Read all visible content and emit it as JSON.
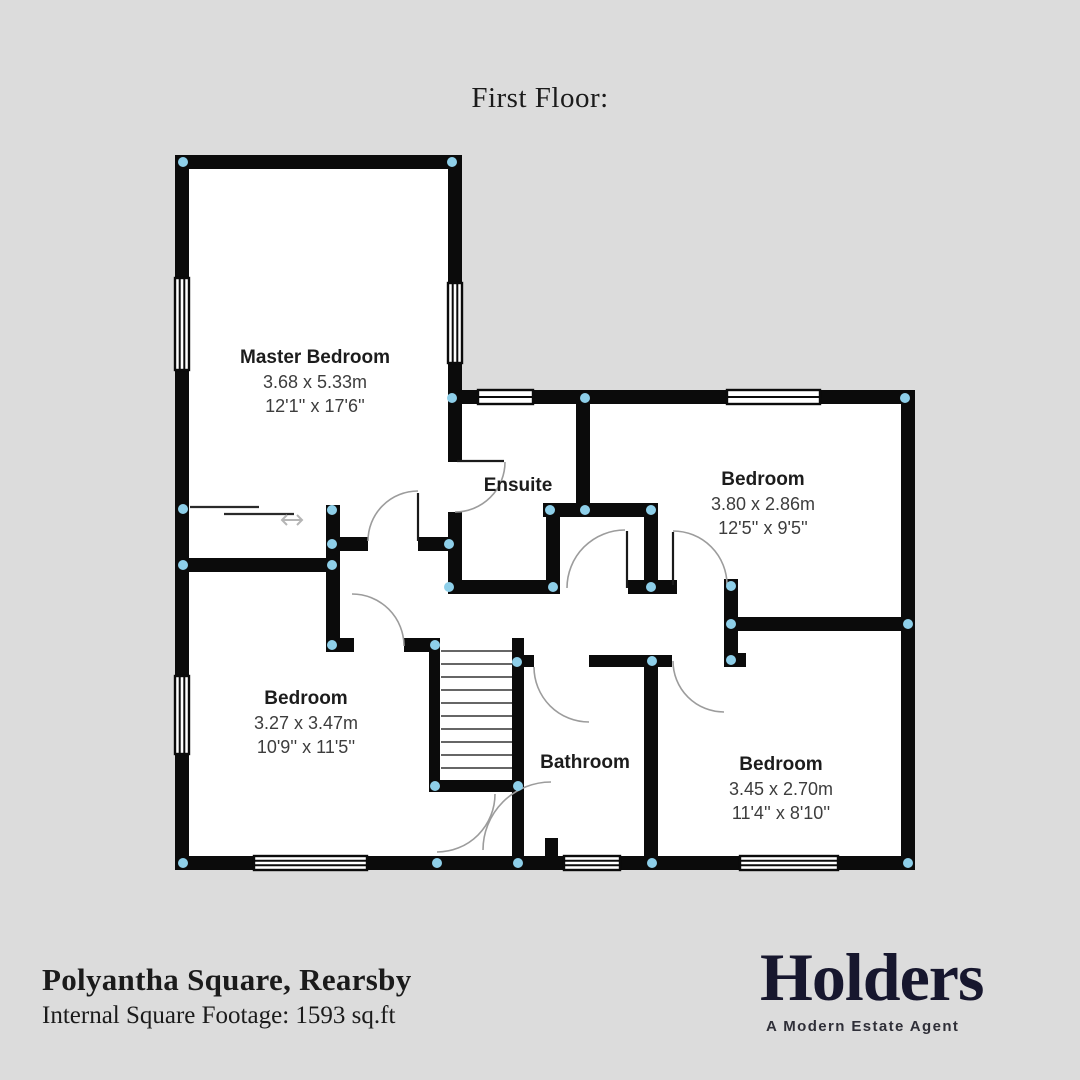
{
  "page": {
    "title": "First Floor:"
  },
  "rooms": [
    {
      "name": "Master Bedroom",
      "dim_m": "3.68 x 5.33m",
      "dim_ft": "12'1'' x 17'6''"
    },
    {
      "name": "Ensuite",
      "dim_m": "",
      "dim_ft": ""
    },
    {
      "name": "Bedroom",
      "dim_m": "3.80 x 2.86m",
      "dim_ft": "12'5'' x 9'5''"
    },
    {
      "name": "Bedroom",
      "dim_m": "3.27 x 3.47m",
      "dim_ft": "10'9'' x 11'5''"
    },
    {
      "name": "Bathroom",
      "dim_m": "",
      "dim_ft": ""
    },
    {
      "name": "Bedroom",
      "dim_m": "3.45 x 2.70m",
      "dim_ft": "11'4'' x 8'10''"
    }
  ],
  "footer": {
    "address": "Polyantha Square, Rearsby",
    "footage": "Internal Square Footage: 1593 sq.ft"
  },
  "logo": {
    "name": "Holders",
    "tagline": "A Modern Estate Agent"
  },
  "theme": {
    "bg": "#dcdcdc",
    "floor": "#ffffff",
    "wall": "#0b0b0b",
    "dot": "#8ecfe9",
    "arc": "#9c9c9c",
    "logo": "#17172e"
  }
}
